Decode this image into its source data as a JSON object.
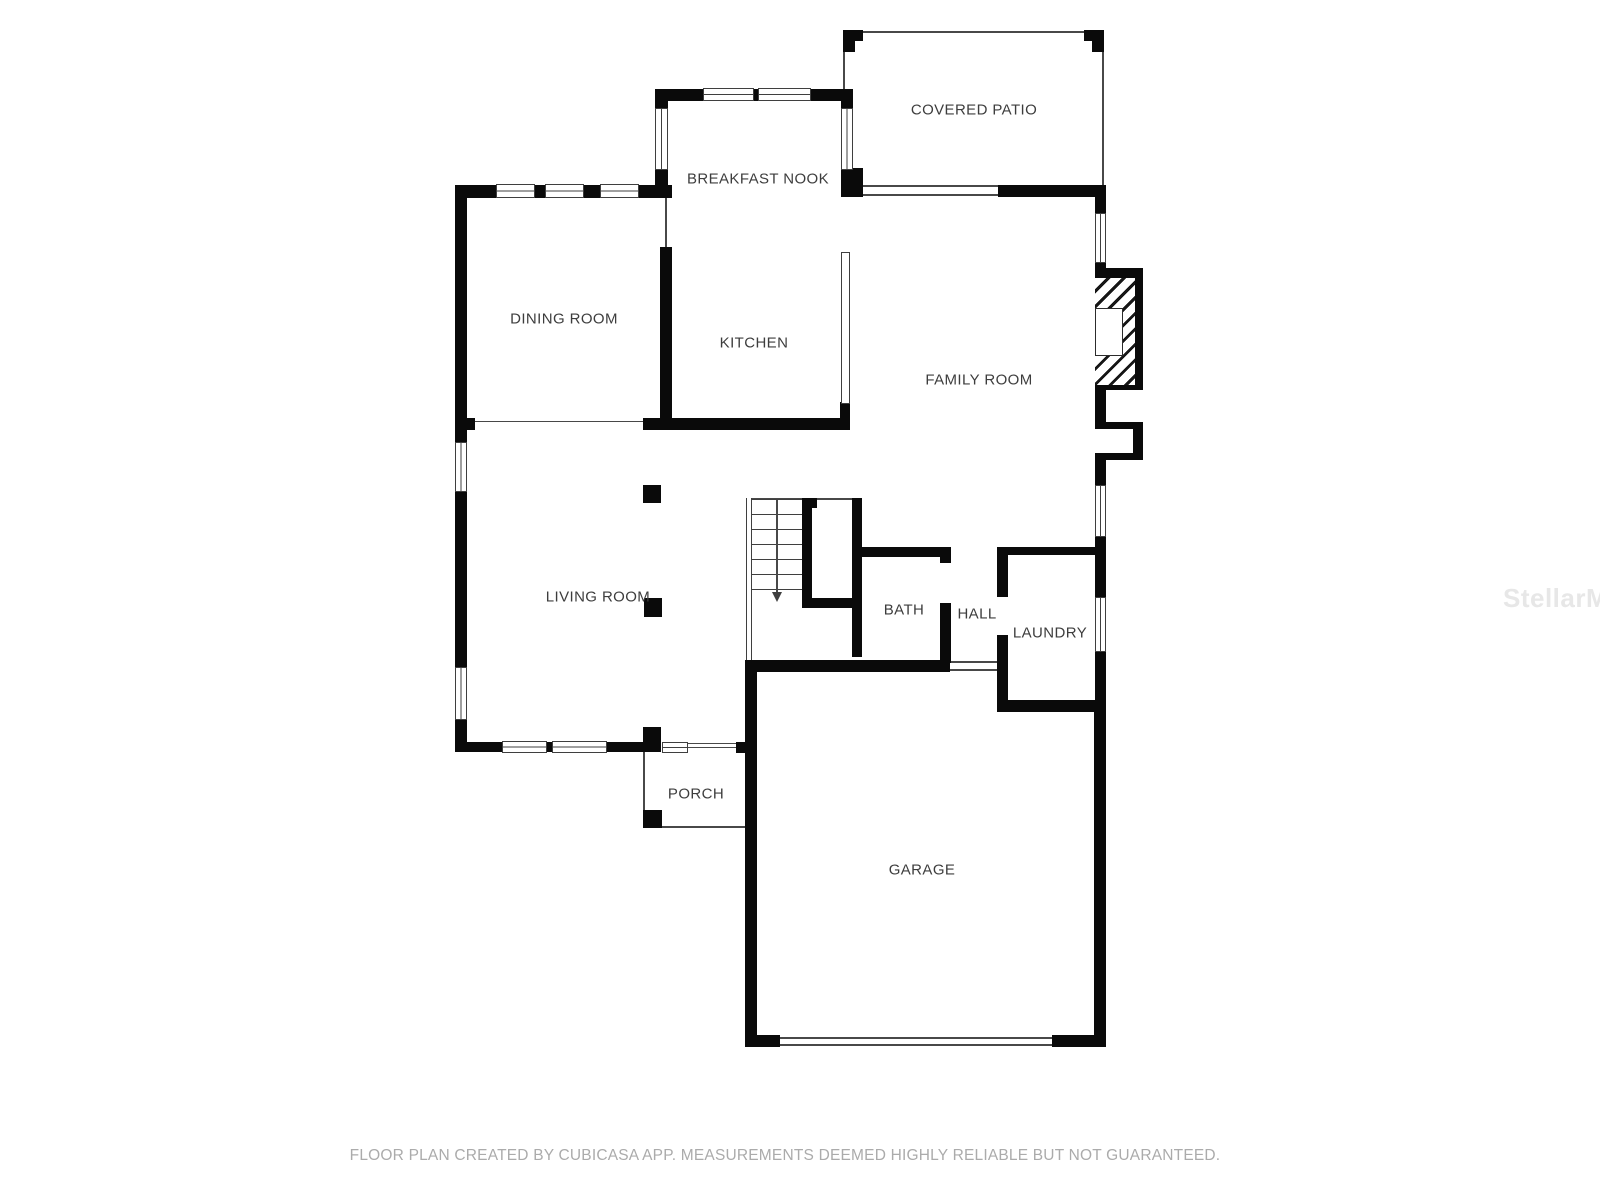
{
  "rooms": {
    "covered_patio": {
      "name": "COVERED PATIO"
    },
    "breakfast_nook": {
      "name": "BREAKFAST NOOK"
    },
    "dining_room": {
      "name": "DINING ROOM"
    },
    "kitchen": {
      "name": "KITCHEN"
    },
    "family_room": {
      "name": "FAMILY ROOM"
    },
    "living_room": {
      "name": "LIVING ROOM"
    },
    "bath": {
      "name": "BATH"
    },
    "hall": {
      "name": "HALL"
    },
    "laundry": {
      "name": "LAUNDRY"
    },
    "porch": {
      "name": "PORCH"
    },
    "garage": {
      "name": "GARAGE"
    }
  },
  "stairs": {
    "arrow_direction": "down"
  },
  "footer": {
    "disclaimer": "FLOOR PLAN CREATED BY CUBICASA APP. MEASUREMENTS DEEMED HIGHLY RELIABLE BUT NOT GUARANTEED."
  },
  "watermark": "StellarMLS",
  "colors": {
    "wall": "#0a0a0a",
    "thin_line": "#484848",
    "label_text": "#3d3d3d",
    "footer_text": "#ababab",
    "watermark_text": "#e7e7e7",
    "background": "#ffffff"
  }
}
